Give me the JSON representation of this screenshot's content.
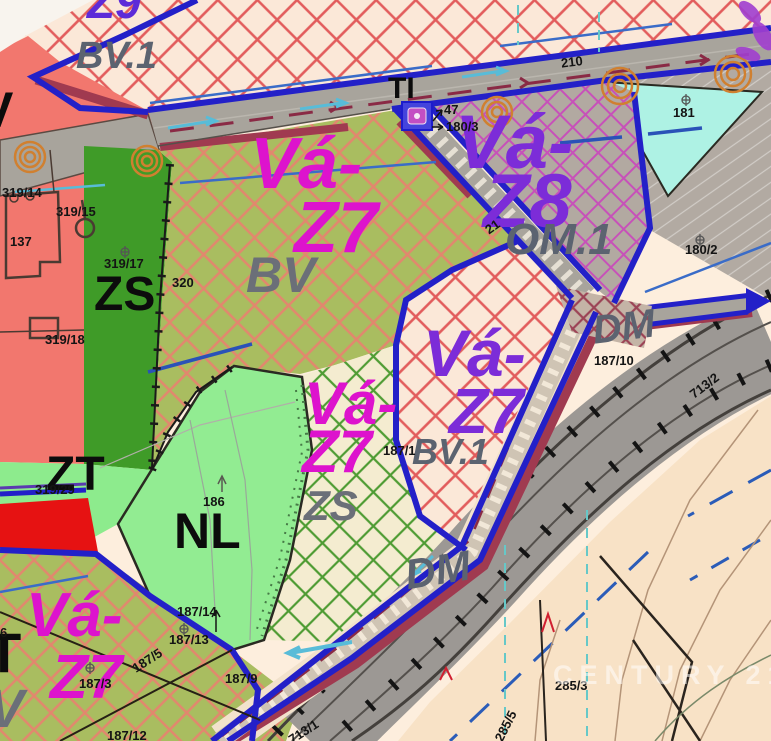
{
  "map": {
    "watermark": "CENTURY 21",
    "colors": {
      "zone_code_magenta": "#dd13cd",
      "zone_code_purple": "#7c2cd8",
      "zone_code_violet": "#5d2bd8",
      "zone_use_gray": "#5b6370",
      "boundary_blue": "#2320c8",
      "corridor_maroon": "#a03a50",
      "residential_hatch_red": "#e25c5c",
      "development_olive": "#a9bd60",
      "greenery_dark": "#3f9b28",
      "meadow_light_green": "#92ec92",
      "water_cyan": "#aef2e4",
      "red_strip": "#e61212"
    },
    "zones": {
      "z9": {
        "label": "Z9",
        "use": "BV.1"
      },
      "vaz7_center": {
        "label_1": "Vá-",
        "label_2": "Z7",
        "use": "BV"
      },
      "vaz8": {
        "label_1": "Vá-",
        "label_2": "Z8",
        "use": "OM.1"
      },
      "vaz7_mid": {
        "label_1": "Vá-",
        "label_2": "Z7",
        "use": "ZS"
      },
      "vaz7_right": {
        "label_1": "Vá-",
        "label_2": "Z7",
        "use": "BV.1"
      },
      "vaz7_bottom": {
        "label_1": "Vá-",
        "label_2": "Z7"
      },
      "zs": {
        "label": "ZS"
      },
      "zt": {
        "label": "ZT"
      },
      "nl": {
        "label": "NL"
      },
      "ti": {
        "label": "TI"
      },
      "dm_right": {
        "label": "DM"
      },
      "dm_bottom": {
        "label": "DM"
      },
      "fragments": {
        "t": "T",
        "v_gray": "V",
        "v_black": "V",
        "six": "6"
      }
    },
    "parcels": {
      "p319_14": "319/14",
      "p319_15": "319/15",
      "p137": "137",
      "p319_17": "319/17",
      "p319_18": "319/18",
      "p320": "320",
      "p319_29": "319/29",
      "p186": "186",
      "p187_14": "187/14",
      "p187_13": "187/13",
      "p187_5": "187/5",
      "p187_3": "187/3",
      "p187_12": "187/12",
      "p187_9": "187/9",
      "p187_1": "187/1",
      "p187_10": "187/10",
      "p181": "181",
      "p180_2": "180/2",
      "p180_3": "180/3",
      "p47": "47",
      "p21": "21",
      "p210": "210",
      "p713_2": "713/2",
      "p713_1": "713/1",
      "p285_3": "285/3",
      "p285_5": "285/5"
    }
  }
}
